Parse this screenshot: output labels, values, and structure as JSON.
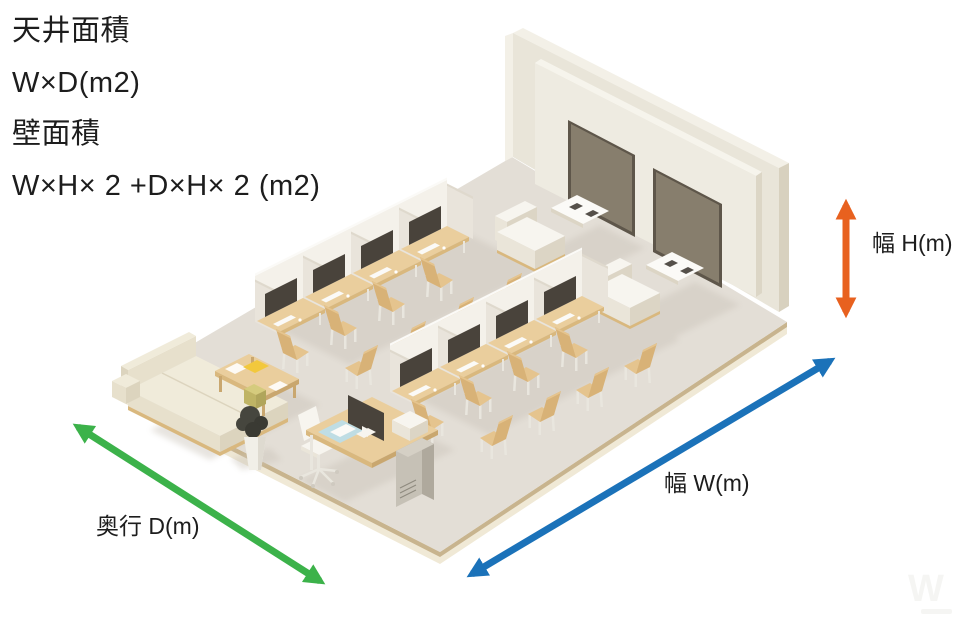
{
  "info_panel": {
    "lines": [
      "天井面積",
      "W×D(m2)",
      "壁面積",
      "W×H× 2 +D×H× 2 (m2)"
    ]
  },
  "dimensions": {
    "height": {
      "label": "幅 H(m)",
      "color": "#E8611F"
    },
    "width": {
      "label": "幅 W(m)",
      "color": "#1B72B9"
    },
    "depth": {
      "label": "奥行 D(m)",
      "color": "#3CB24A"
    }
  },
  "watermark": {
    "letter": "W"
  },
  "palette": {
    "arrow_orange": "#E8611F",
    "arrow_blue": "#1B72B9",
    "arrow_green": "#3CB24A",
    "floor": "#E3DED6",
    "floor_edge_light": "#F0E9D6",
    "floor_edge_tan": "#C8B48E",
    "wall_face": "#E9E5D9",
    "wall_top": "#F3F0E7",
    "wall_side": "#D8D1BF",
    "panel_face": "#EEEBE1",
    "panel_edge": "#F6F4EC",
    "panel_side": "#DCD6C6",
    "screen": "#877E6D",
    "screen_border": "#5E564A",
    "partition_bright": "#F4F1EA",
    "partition_shade": "#E9E4DB",
    "partition_edge": "#DFD9CD",
    "white_edge": "#FBFAF7",
    "desk_top": "#EACE9D",
    "desk_edge": "#D9B87E",
    "wood_dark": "#C9A76F",
    "chair_seat": "#E5C48E",
    "chair_back": "#D8B277",
    "monitor_dark": "#49433B",
    "white_obj": "#F7F5EF",
    "white_obj_shade": "#EAE5D9",
    "white_obj_dark": "#DCD5C5",
    "sofa_top": "#F0EBDA",
    "sofa_face": "#E7E0CC",
    "sofa_side": "#DCD4BE",
    "metal_light": "#E9E6DE",
    "shadow": "#CBC4BA",
    "pc_tower": "#C6C1B6",
    "pc_tower_side": "#AFA99D",
    "plant_dark": "#46463E",
    "plant_cube": "#D5CB7D",
    "plant_cube_side": "#BFB465",
    "planter": "#F1EFE8",
    "planter_side": "#DEDAD0",
    "book_yellow": "#F2C83C",
    "kb_blue": "#BFDDE4",
    "ctrl_dark": "#55504A",
    "wm": "#F5F5F3"
  }
}
